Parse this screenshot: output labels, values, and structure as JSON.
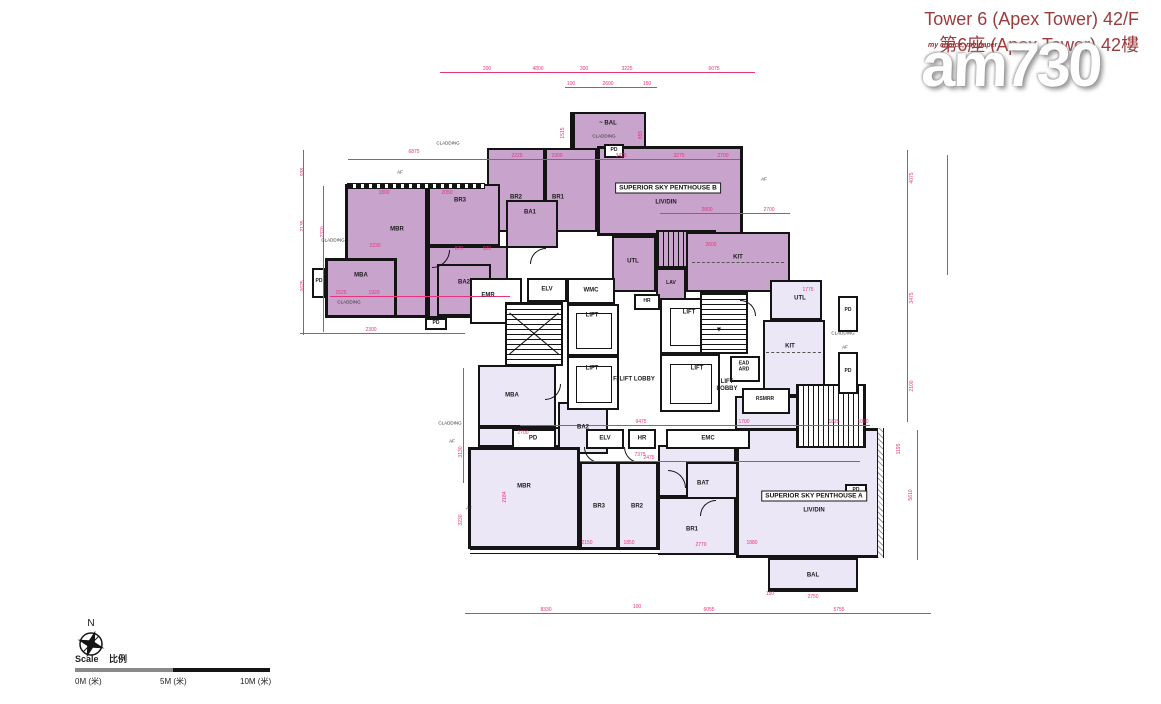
{
  "header": {
    "title_line1": "Tower 6 (Apex Tower) 42/F",
    "title_line2": "第6座 (Apex Tower) 42樓"
  },
  "watermark": {
    "logo": "am730",
    "tagline": "my choice, my paper"
  },
  "plan": {
    "penthouse_b": {
      "name": "SUPERIOR SKY PENTHOUSE B",
      "livdin": "LIV/DIN",
      "bal": "~ BAL",
      "br1": "BR1",
      "br2": "BR2",
      "br3": "BR3",
      "mbr": "MBR",
      "ba1": "BA1",
      "ba2": "BA2",
      "mba": "MBA",
      "kit": "KIT",
      "utl": "UTL",
      "lav": "LAV"
    },
    "penthouse_a": {
      "name": "SUPERIOR SKY PENTHOUSE A",
      "livdin": "LIV/DIN",
      "bal": "BAL",
      "br1": "BR1",
      "br2": "BR2",
      "br3": "BR3",
      "mbr": "MBR",
      "bat": "BAT",
      "ba2": "BA2",
      "mba": "MBA",
      "kit": "KIT",
      "utl": "UTL"
    },
    "core": {
      "emr": "EMR",
      "elv": "ELV",
      "wmc": "WMC",
      "hr": "HR",
      "lift": "LIFT",
      "f_lift_lobby": "F. LIFT LOBBY",
      "lift_lobby": "LIFT LOBBY",
      "ead_ard": "EAD ARD",
      "rsmrr": "RSMRR",
      "pd": "PD",
      "emc": "EMC"
    },
    "annotations": {
      "cladding": "CLADDING",
      "af": "AF"
    }
  },
  "compass": {
    "north": "N"
  },
  "scalebar": {
    "label_en": "Scale",
    "label_zh": "比例",
    "tick0": "0M (米)",
    "tick5": "5M (米)",
    "tick10": "10M (米)"
  },
  "colors": {
    "penthouse_b_fill": "#c8a3cc",
    "penthouse_a_fill": "#ece7f7",
    "dimension_pink": "#e8347c",
    "wall": "#141414",
    "title_red": "#9c3b3b"
  },
  "dims": [
    {
      "t": "200",
      "x": 487,
      "y": 69
    },
    {
      "t": "4800",
      "x": 538,
      "y": 69
    },
    {
      "t": "300",
      "x": 584,
      "y": 69
    },
    {
      "t": "3225",
      "x": 627,
      "y": 69
    },
    {
      "t": "6075",
      "x": 714,
      "y": 69
    },
    {
      "t": "100",
      "x": 571,
      "y": 84
    },
    {
      "t": "2600",
      "x": 608,
      "y": 84
    },
    {
      "t": "150",
      "x": 647,
      "y": 84
    },
    {
      "t": "938",
      "x": 303,
      "y": 172,
      "v": true
    },
    {
      "t": "2135",
      "x": 303,
      "y": 226,
      "v": true
    },
    {
      "t": "2625",
      "x": 303,
      "y": 286,
      "v": true
    },
    {
      "t": "2320",
      "x": 323,
      "y": 232,
      "v": true
    },
    {
      "t": "6875",
      "x": 414,
      "y": 152
    },
    {
      "t": "1800",
      "x": 384,
      "y": 193
    },
    {
      "t": "2050",
      "x": 447,
      "y": 193
    },
    {
      "t": "2225",
      "x": 517,
      "y": 156
    },
    {
      "t": "2300",
      "x": 557,
      "y": 156
    },
    {
      "t": "3425",
      "x": 621,
      "y": 156
    },
    {
      "t": "3275",
      "x": 679,
      "y": 156
    },
    {
      "t": "2700",
      "x": 723,
      "y": 156
    },
    {
      "t": "2800",
      "x": 707,
      "y": 210
    },
    {
      "t": "2700",
      "x": 769,
      "y": 210
    },
    {
      "t": "2230",
      "x": 375,
      "y": 246
    },
    {
      "t": "1525",
      "x": 341,
      "y": 293
    },
    {
      "t": "1920",
      "x": 374,
      "y": 293
    },
    {
      "t": "2300",
      "x": 371,
      "y": 330
    },
    {
      "t": "870",
      "x": 459,
      "y": 249
    },
    {
      "t": "920",
      "x": 487,
      "y": 249
    },
    {
      "t": "2600",
      "x": 711,
      "y": 245
    },
    {
      "t": "1515",
      "x": 563,
      "y": 133,
      "v": true
    },
    {
      "t": "855",
      "x": 641,
      "y": 135,
      "v": true
    },
    {
      "t": "4075",
      "x": 912,
      "y": 178,
      "v": true
    },
    {
      "t": "3475",
      "x": 912,
      "y": 298,
      "v": true
    },
    {
      "t": "2100",
      "x": 912,
      "y": 386,
      "v": true
    },
    {
      "t": "1775",
      "x": 808,
      "y": 290
    },
    {
      "t": "9475",
      "x": 641,
      "y": 422
    },
    {
      "t": "1700",
      "x": 744,
      "y": 422
    },
    {
      "t": "1825",
      "x": 834,
      "y": 422
    },
    {
      "t": "1080",
      "x": 863,
      "y": 422
    },
    {
      "t": "2700",
      "x": 523,
      "y": 433
    },
    {
      "t": "2475",
      "x": 649,
      "y": 458
    },
    {
      "t": "7375",
      "x": 640,
      "y": 455
    },
    {
      "t": "2184",
      "x": 505,
      "y": 497,
      "v": true
    },
    {
      "t": "3130",
      "x": 461,
      "y": 452,
      "v": true
    },
    {
      "t": "3230",
      "x": 461,
      "y": 520,
      "v": true
    },
    {
      "t": "2150",
      "x": 587,
      "y": 543
    },
    {
      "t": "1850",
      "x": 629,
      "y": 543
    },
    {
      "t": "2770",
      "x": 701,
      "y": 545
    },
    {
      "t": "1880",
      "x": 752,
      "y": 543
    },
    {
      "t": "150",
      "x": 770,
      "y": 594
    },
    {
      "t": "2750",
      "x": 813,
      "y": 597
    },
    {
      "t": "5610",
      "x": 911,
      "y": 495,
      "v": true
    },
    {
      "t": "1195",
      "x": 899,
      "y": 449,
      "v": true
    },
    {
      "t": "8330",
      "x": 546,
      "y": 610
    },
    {
      "t": "100",
      "x": 637,
      "y": 607
    },
    {
      "t": "6055",
      "x": 709,
      "y": 610
    },
    {
      "t": "5755",
      "x": 839,
      "y": 610
    }
  ],
  "annos": [
    {
      "t": "CLADDING",
      "x": 448,
      "y": 143
    },
    {
      "t": "CLADDING",
      "x": 604,
      "y": 136
    },
    {
      "t": "CLADDING",
      "x": 333,
      "y": 240
    },
    {
      "t": "CLADDING",
      "x": 349,
      "y": 302
    },
    {
      "t": "CLADDING",
      "x": 843,
      "y": 333
    },
    {
      "t": "CLADDING",
      "x": 450,
      "y": 423
    },
    {
      "t": "AF",
      "x": 400,
      "y": 172
    },
    {
      "t": "AF",
      "x": 764,
      "y": 179
    },
    {
      "t": "AF",
      "x": 845,
      "y": 347
    },
    {
      "t": "AF",
      "x": 452,
      "y": 441
    },
    {
      "t": "AF",
      "x": 469,
      "y": 508
    }
  ]
}
